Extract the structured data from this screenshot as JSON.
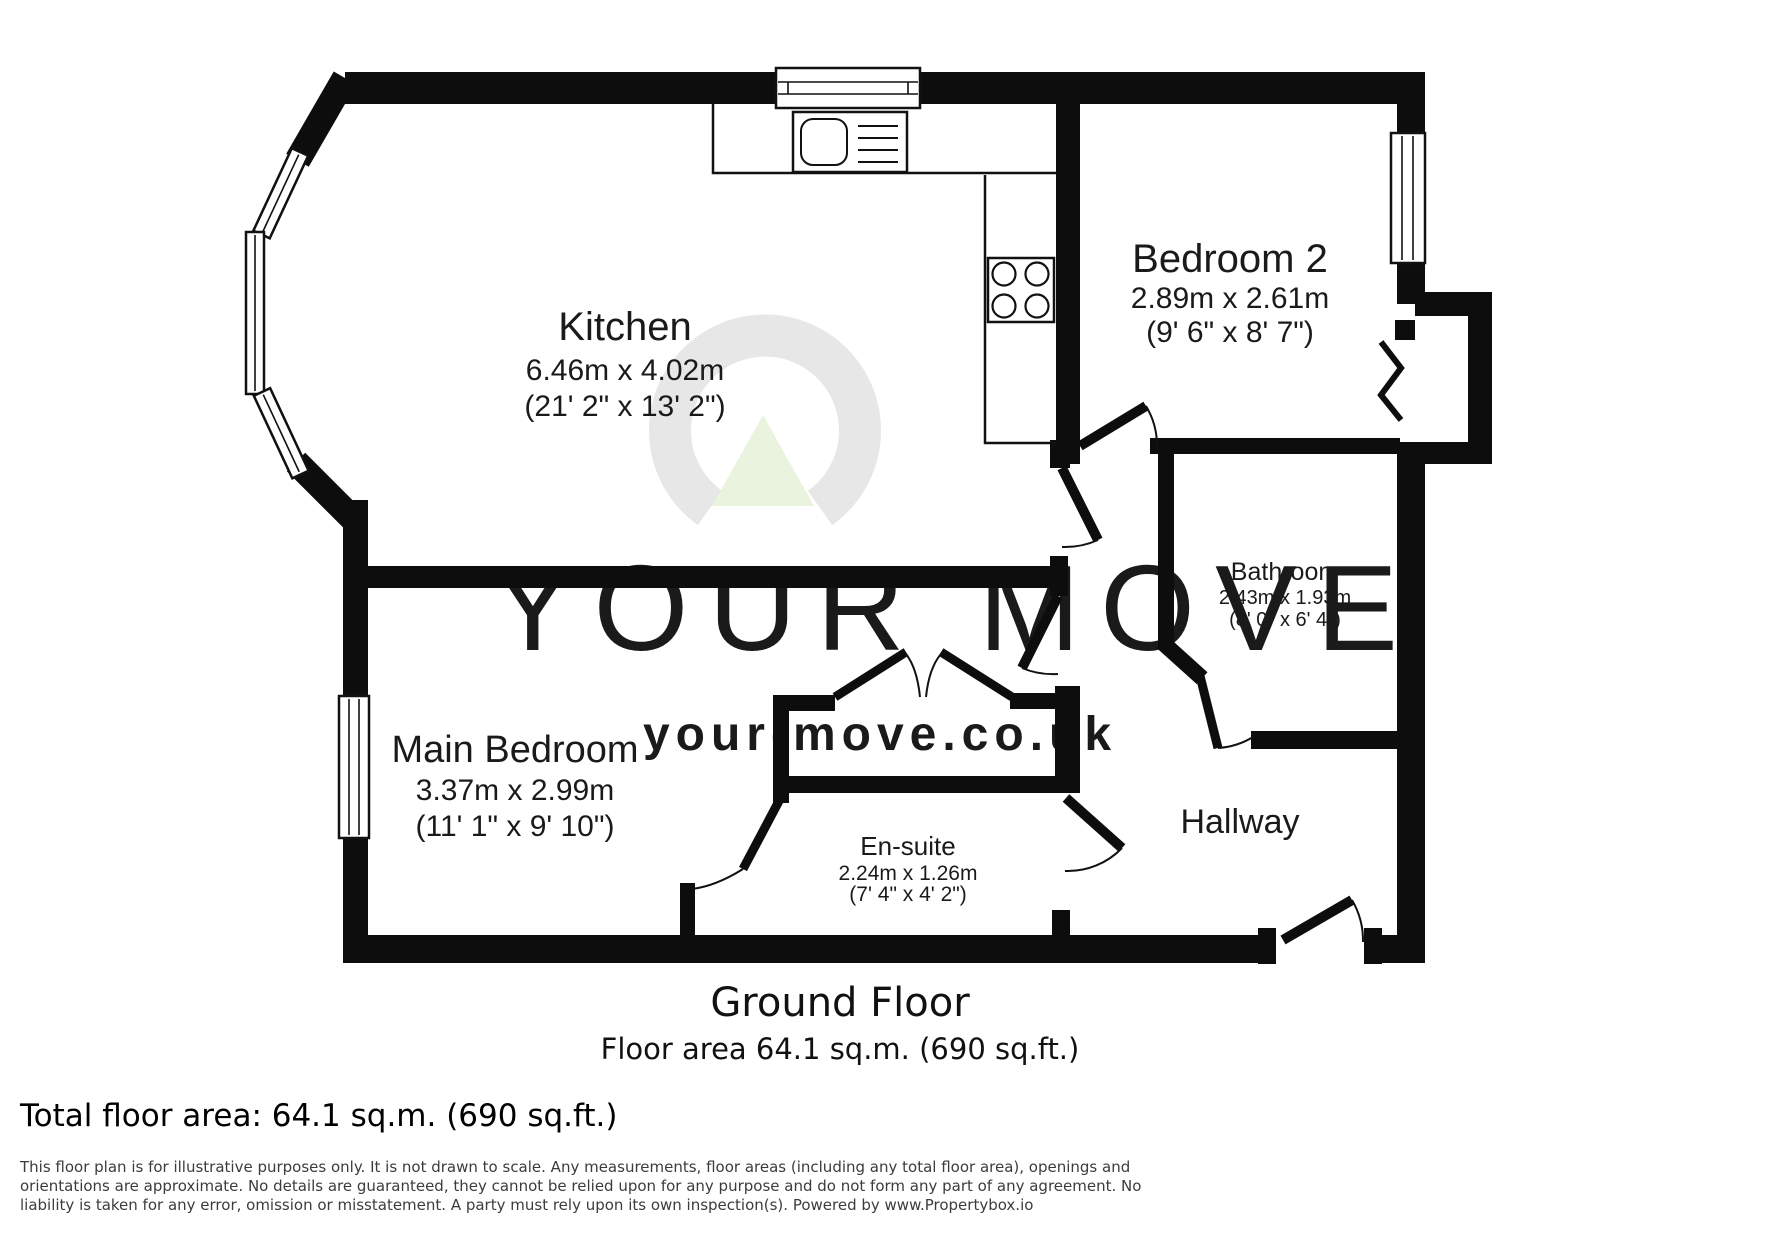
{
  "floorplan": {
    "floor_title": "Ground Floor",
    "floor_area_line": "Floor area 64.1 sq.m. (690 sq.ft.)",
    "rooms": [
      {
        "id": "kitchen",
        "name": "Kitchen",
        "dims_m": "6.46m x 4.02m",
        "dims_ft": "(21' 2\" x 13' 2\")"
      },
      {
        "id": "bedroom2",
        "name": "Bedroom 2",
        "dims_m": "2.89m x 2.61m",
        "dims_ft": "(9' 6\" x 8' 7\")"
      },
      {
        "id": "bathroom",
        "name": "Bathroom",
        "dims_m": "2.43m x 1.93m",
        "dims_ft": "(8' 0\" x 6' 4\")"
      },
      {
        "id": "main_bedroom",
        "name": "Main Bedroom",
        "dims_m": "3.37m x 2.99m",
        "dims_ft": "(11' 1\" x 9' 10\")"
      },
      {
        "id": "ensuite",
        "name": "En-suite",
        "dims_m": "2.24m x 1.26m",
        "dims_ft": "(7' 4\" x 4' 2\")"
      },
      {
        "id": "hallway",
        "name": "Hallway"
      }
    ]
  },
  "watermark": {
    "brand": "YOUR MOVE",
    "url": "your-move.co.uk",
    "ring_color": "#e7e7e7",
    "triangle_color": "#e9f3dd",
    "brand_text_color": "#ebebeb",
    "url_text_color": "#e3f0d6"
  },
  "footer": {
    "total_area": "Total floor area: 64.1 sq.m. (690 sq.ft.)",
    "disclaimer": "This floor plan is for illustrative purposes only. It is not drawn to scale. Any measurements, floor areas (including any total floor area), openings and orientations are approximate. No details are guaranteed, they cannot be relied upon for any purpose and do not form any part of any agreement. No liability is taken for any error, omission or misstatement. A party must rely upon its own inspection(s). Powered by www.Propertybox.io"
  },
  "colors": {
    "wall": "#0d0d0d",
    "line": "#111111",
    "label": "#1a1a1a"
  }
}
